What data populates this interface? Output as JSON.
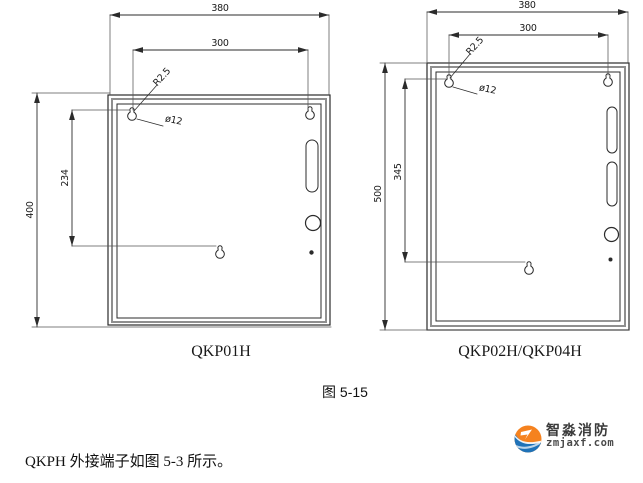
{
  "colors": {
    "line": "#2b2b2b",
    "frame_gray": "#8f8f8f",
    "extension_line": "#555555",
    "logo_orange": "#f5821f",
    "logo_blue": "#1f72b8"
  },
  "drawings": {
    "left": {
      "label": "QKP01H",
      "dims": {
        "overall_width": "380",
        "hole_spacing_horizontal": "300",
        "overall_height": "400",
        "hole_spacing_vertical": "234",
        "corner_radius": "R2.5",
        "hole_diameter": "ø12"
      }
    },
    "right": {
      "label": "QKP02H/QKP04H",
      "dims": {
        "overall_width": "380",
        "hole_spacing_horizontal": "300",
        "overall_height": "500",
        "hole_spacing_vertical": "345",
        "corner_radius": "R2.5",
        "hole_diameter": "ø12"
      }
    }
  },
  "caption": "图 5-15",
  "body_text": "QKPH 外接端子如图 5-3 所示。",
  "logo": {
    "name": "智淼消防",
    "site": "zmjaxf.com"
  }
}
